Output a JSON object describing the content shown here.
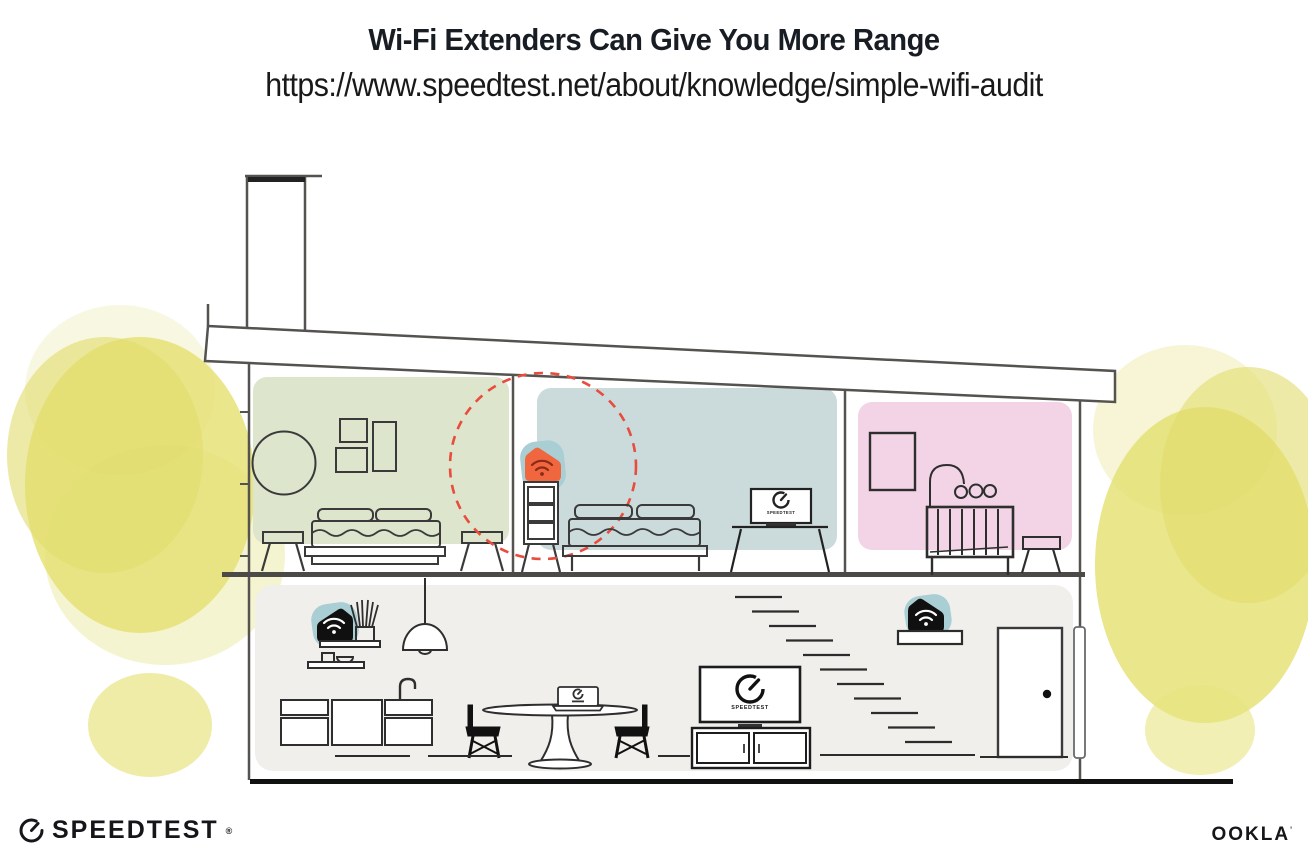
{
  "header": {
    "title": "Wi-Fi Extenders Can Give You More Range",
    "url": "https://www.speedtest.net/about/knowledge/simple-wifi-audit"
  },
  "brand": {
    "speedtest": "SPEEDTEST",
    "speedtest_reg": "®",
    "ookla": "OOKLA",
    "ookla_mark": "'"
  },
  "illustration": {
    "upstairs_tv_label": "SPEEDTEST",
    "downstairs_tv_label": "SPEEDTEST",
    "colors": {
      "room_green": "#DDE5CD",
      "room_blue": "#CBDBDC",
      "room_pink": "#F2D4E6",
      "downstairs_gray": "#F0EFEC",
      "extender_teal": "#A9CED4",
      "extender_orange": "#F0663F",
      "device_black": "#101010",
      "coverage_red": "#E84C3D",
      "foliage_yellow": "#E4DF6F",
      "structure_gray": "#55534F"
    },
    "devices": [
      {
        "id": "extender-upstairs-hallway",
        "icon": "wifi-icon"
      },
      {
        "id": "router-downstairs-shelf",
        "icon": "wifi-icon"
      },
      {
        "id": "extender-downstairs-entry",
        "icon": "wifi-icon"
      }
    ],
    "coverage": {
      "shape": "dashed-circle",
      "around": "extender-upstairs-hallway"
    }
  }
}
